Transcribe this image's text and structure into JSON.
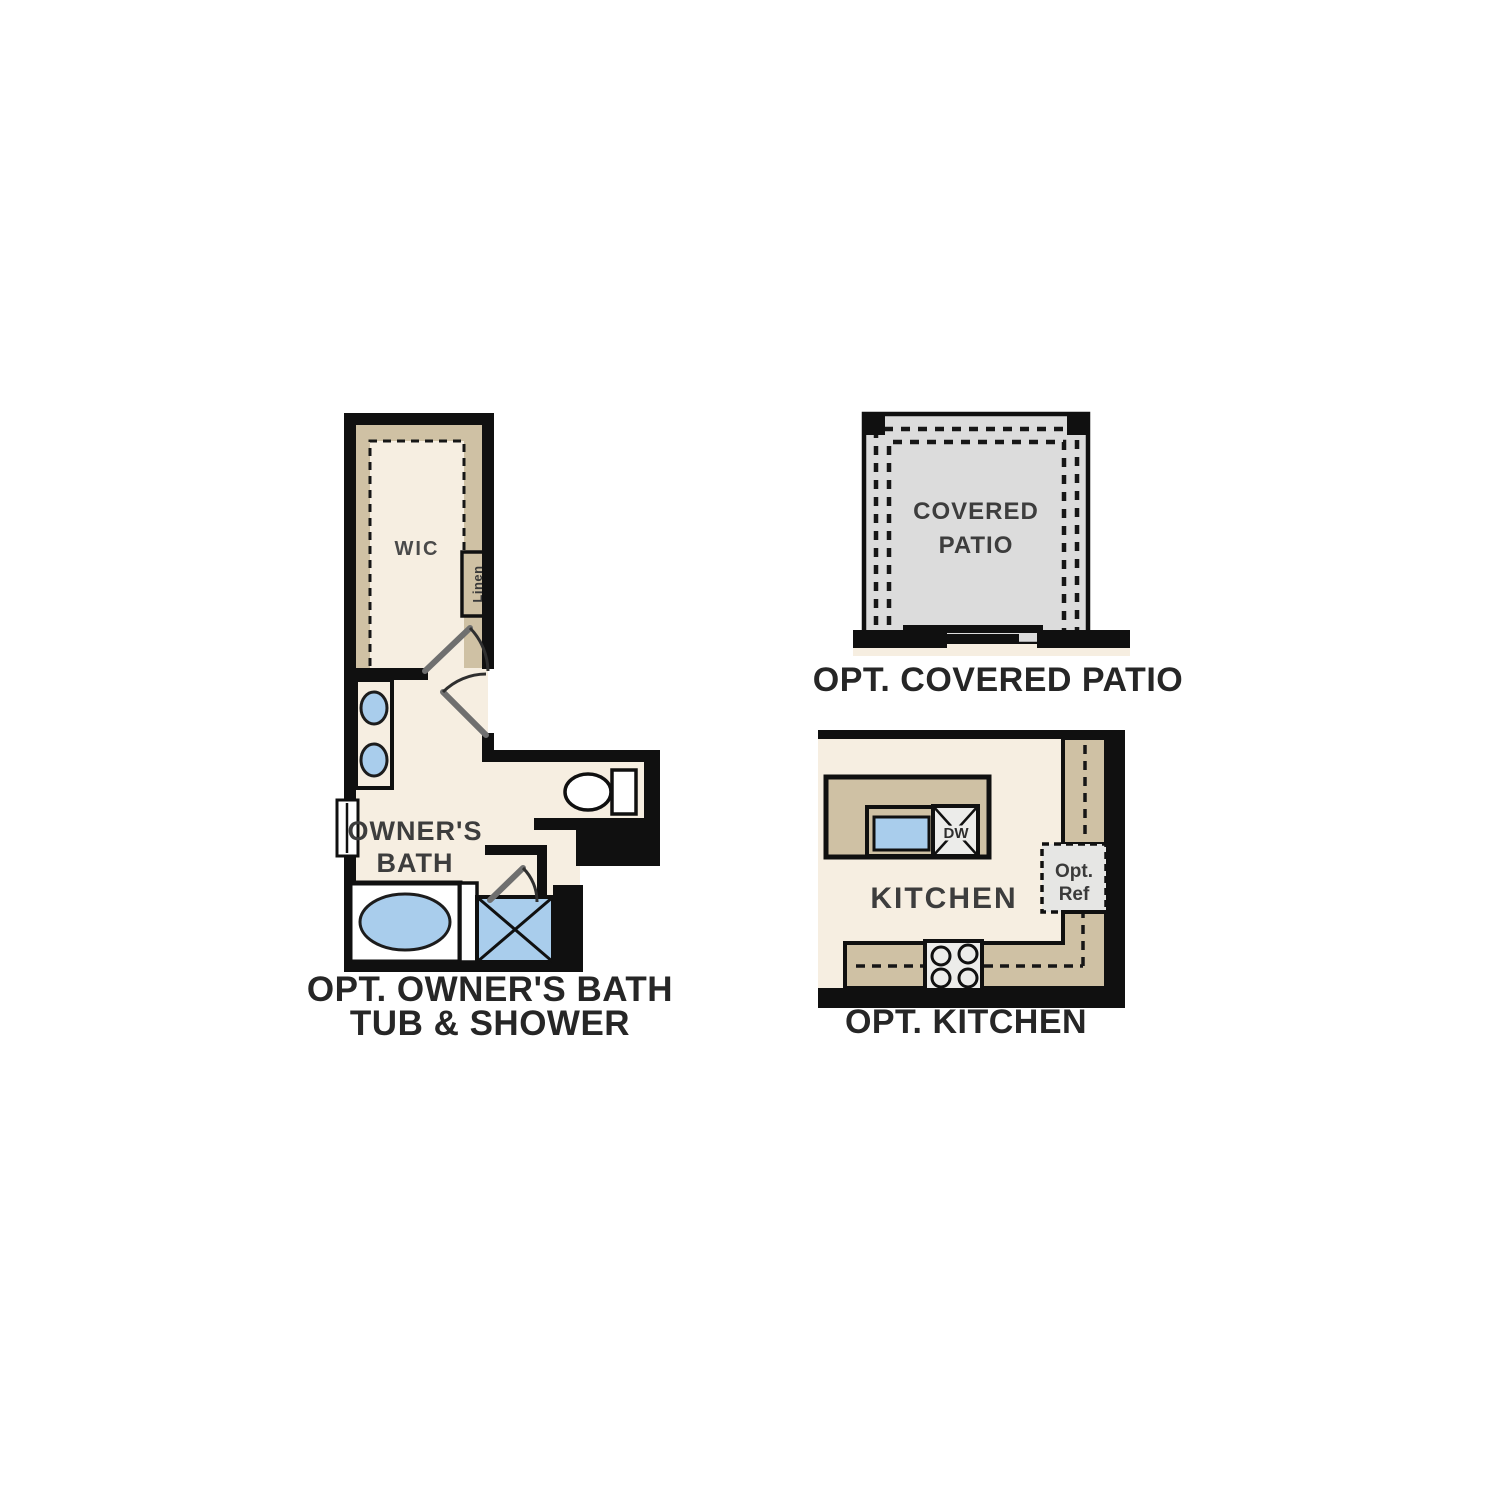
{
  "page": {
    "background": "#ffffff"
  },
  "colors": {
    "wall": "#101010",
    "floor_cream": "#f6eee1",
    "cabinet_tan": "#cfc1a4",
    "fixture_blue": "#a9cdec",
    "fixture_white": "#ffffff",
    "patio_gray": "#dcdcdc",
    "appliance_gray": "#ececea",
    "ref_gray": "#e6e6e4",
    "label_gray": "#3d3d3d",
    "caption_dark": "#262626"
  },
  "plans": {
    "owners_bath": {
      "caption_line1": "OPT. OWNER'S BATH",
      "caption_line2": "TUB & SHOWER",
      "labels": {
        "wic": "WIC",
        "linen": "Linen",
        "room_line1": "OWNER'S",
        "room_line2": "BATH"
      }
    },
    "covered_patio": {
      "caption": "OPT. COVERED PATIO",
      "labels": {
        "room_line1": "COVERED",
        "room_line2": "PATIO"
      }
    },
    "kitchen": {
      "caption": "OPT. KITCHEN",
      "labels": {
        "room": "KITCHEN",
        "dishwasher": "DW",
        "opt_ref_line1": "Opt.",
        "opt_ref_line2": "Ref"
      }
    }
  }
}
